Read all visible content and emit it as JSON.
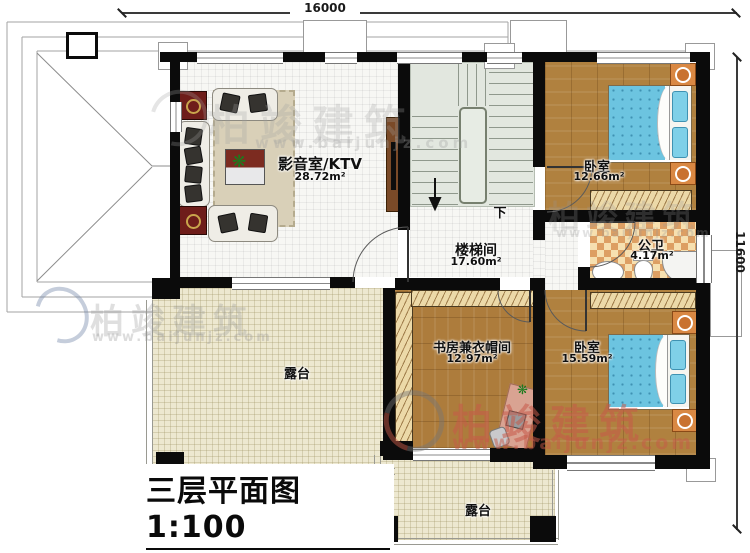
{
  "dimensions": {
    "top": "16000",
    "right": "11600"
  },
  "rooms": {
    "media": {
      "name": "影音室/KTV",
      "area": "28.72m²"
    },
    "stairwell": {
      "name": "楼梯间",
      "area": "17.60m²",
      "down": "下"
    },
    "bedroom_top": {
      "name": "卧室",
      "area": "12.66m²"
    },
    "bathroom": {
      "name": "公卫",
      "area": "4.17m²"
    },
    "study": {
      "name": "书房兼衣帽间",
      "area": "12.97m²"
    },
    "bedroom_bottom": {
      "name": "卧室",
      "area": "15.59m²"
    },
    "terrace_left": {
      "name": "露台"
    },
    "terrace_bottom": {
      "name": "露台"
    }
  },
  "titleblock": {
    "title": "三层平面图",
    "scale": "1:100",
    "area_label": "本层建筑面积:",
    "area_value": "108.24m²",
    "height_label": "层高:",
    "height_value": "2.6m"
  },
  "watermark": {
    "brand": "柏竣建筑",
    "url": "www.baijunjz.com"
  },
  "colors": {
    "wall": "#0b0b0b",
    "wood_floor": "#b0813f",
    "terrace_floor": "#ede8d0",
    "stair_floor": "#e2e7df",
    "bathroom_tile_light": "#f6e0b0",
    "bathroom_tile_dark": "#dd9f63",
    "bed_blue": "#6cc4e0",
    "nightstand_orange": "#d98843",
    "watermark_red": "#c65a48"
  }
}
